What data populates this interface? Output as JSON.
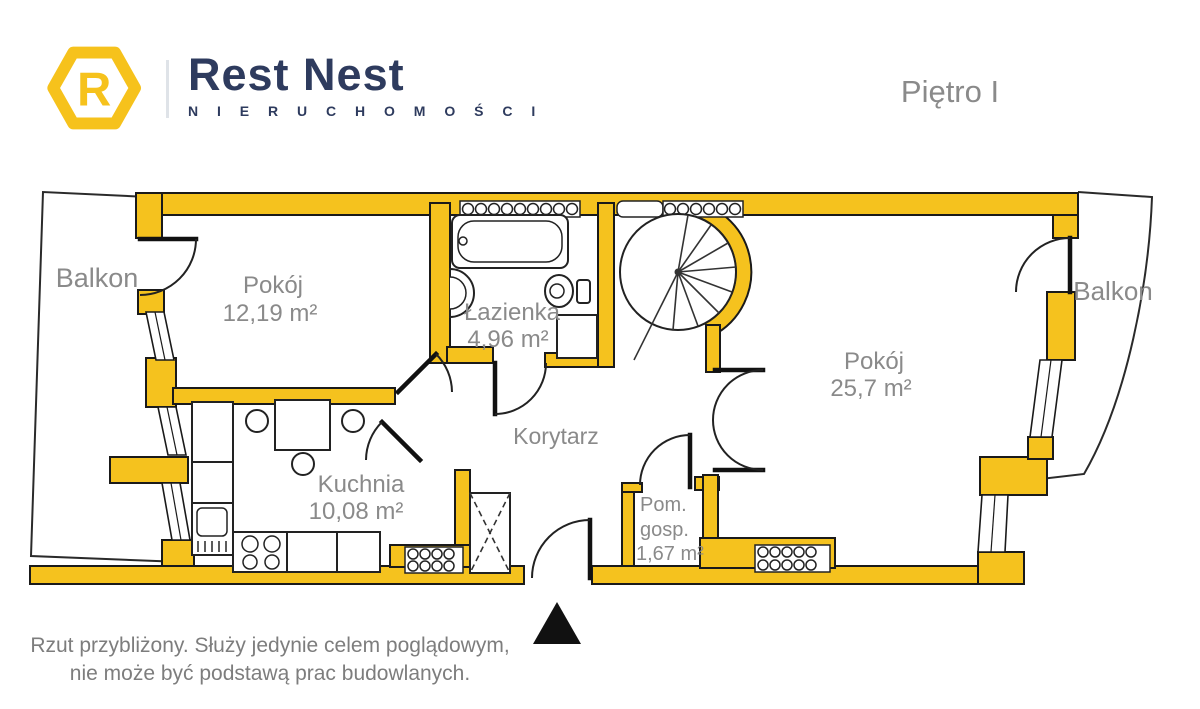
{
  "header": {
    "brand": {
      "logo_letter": "R",
      "name": "Rest Nest",
      "tagline": "N I E R U C H O M O Ś C I"
    },
    "floor_label": "Piętro I"
  },
  "plan": {
    "rooms": {
      "balkon_left": {
        "label": "Balkon"
      },
      "pokoj_left": {
        "label": "Pokój",
        "area": "12,19 m²"
      },
      "lazienka": {
        "label": "Łazienka",
        "area": "4,96 m²"
      },
      "kuchnia": {
        "label": "Kuchnia",
        "area": "10,08 m²"
      },
      "korytarz": {
        "label": "Korytarz"
      },
      "pom_gosp": {
        "label_line1": "Pom.",
        "label_line2": "gosp.",
        "area": "1,67 m²"
      },
      "pokoj_right": {
        "label": "Pokój",
        "area": "25,7 m²"
      },
      "balkon_right": {
        "label": "Balkon"
      }
    }
  },
  "footer": {
    "disclaimer_line1": "Rzut przybliżony. Służy jedynie celem poglądowym,",
    "disclaimer_line2": "nie może być podstawą prac budowlanych."
  },
  "colors": {
    "wall_yellow": "#F5C21E",
    "brand_navy": "#2E3B5E",
    "label_gray": "#8A8A8A",
    "line_black": "#1A1A1A"
  }
}
